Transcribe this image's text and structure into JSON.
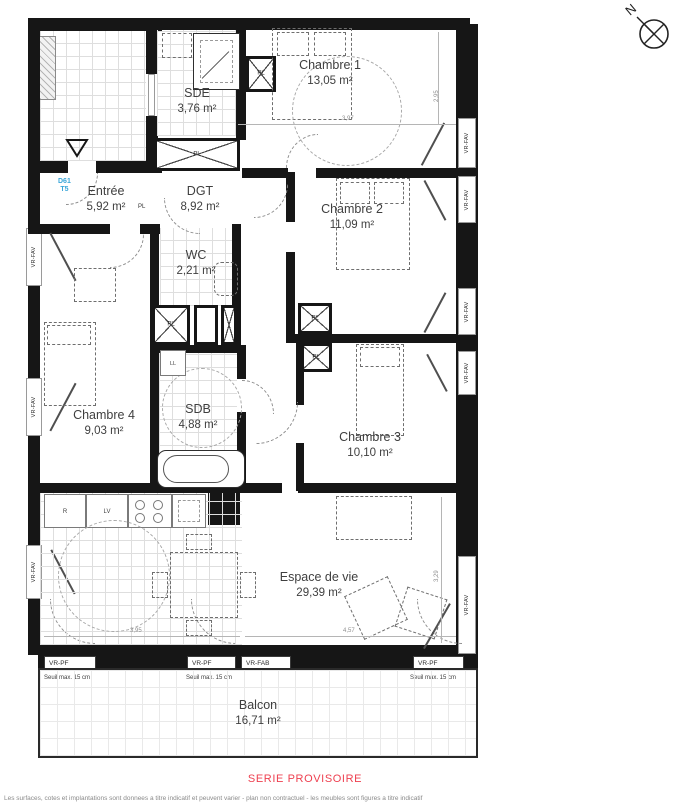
{
  "compass": {
    "label": "N"
  },
  "unit_tag": {
    "id": "D61",
    "type": "T5"
  },
  "rooms": {
    "sde": {
      "name": "SDE",
      "area": "3,76 m²"
    },
    "chambre1": {
      "name": "Chambre 1",
      "area": "13,05 m²"
    },
    "entree": {
      "name": "Entrée",
      "area": "5,92 m²"
    },
    "dgt": {
      "name": "DGT",
      "area": "8,92 m²"
    },
    "chambre2": {
      "name": "Chambre 2",
      "area": "11,09 m²"
    },
    "wc": {
      "name": "WC",
      "area": "2,21 m²"
    },
    "chambre4": {
      "name": "Chambre 4",
      "area": "9,03 m²"
    },
    "sdb": {
      "name": "SDB",
      "area": "4,88 m²"
    },
    "chambre3": {
      "name": "Chambre 3",
      "area": "10,10 m²"
    },
    "espace": {
      "name": "Espace de vie",
      "area": "29,39 m²"
    },
    "balcon": {
      "name": "Balcon",
      "area": "16,71 m²"
    }
  },
  "fixtures": {
    "pl": "PL",
    "ll": "LL",
    "r": "R",
    "lv": "LV"
  },
  "windows": {
    "vr_fav": "VR-FAV",
    "vr_pf": "VR-PF",
    "vr_fab": "VR-FAB",
    "seuil": "Seuil max. 15 cm"
  },
  "dimensions": {
    "chambre1_width": "3,97",
    "chambre1_height": "2,95",
    "kitchen_width": "3,95",
    "living_width": "4,57",
    "living_height": "3,29"
  },
  "footer": {
    "stamp": "SERIE PROVISOIRE",
    "disclaimer": "Les surfaces, cotes et implantations sont donnees a titre indicatif et peuvent varier - plan non contractuel - les meubles sont figures a titre indicatif"
  },
  "colors": {
    "wall": "#161616",
    "accent_blue": "#3aa6d9",
    "stamp_red": "#ee4050"
  }
}
